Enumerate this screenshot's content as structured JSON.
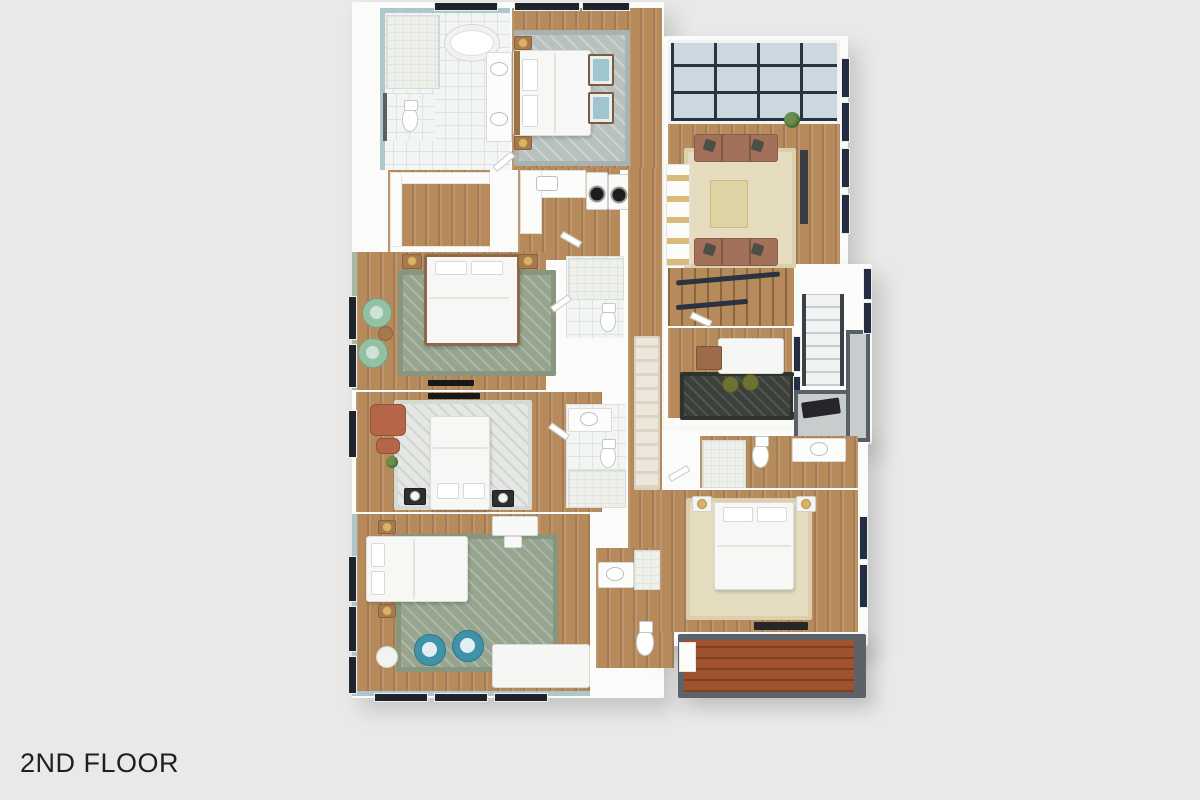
{
  "caption": {
    "text": "2ND FLOOR"
  },
  "palette": {
    "bg": "#e9e9e8",
    "wall": "#fbfbfa",
    "wood": "#b78a5c",
    "tile": "#f3f5f4",
    "tileLine": "#dde3e2",
    "showerTile": "#eef0ec",
    "blueWall": "#aec7cd",
    "sageWall": "#a9b8a2",
    "skyGlass": "#ccd8df",
    "skyFrame": "#2b3340",
    "windowDark": "#1e242c",
    "windowNavy": "#232e42",
    "rugGray": "#b9c1be",
    "rugSage": "#97a48f",
    "rugWhite": "#e4e7e3",
    "rugCream": "#e6dcc0",
    "rugDark": "#3b403a",
    "runner": "#ece7db",
    "sofaBrown": "#a3705a",
    "chairYellow": "#dfc76d",
    "chairGreen": "#93c1a4",
    "chairTeal": "#3f93a8",
    "chairTerracotta": "#b5654a",
    "poufOlive": "#6e7034",
    "deck": "#a0522e",
    "deckFrame": "#5c6268",
    "landing": "#c9cccd",
    "landingFrame": "#595f66",
    "furnDark": "#26262a",
    "woodFurn": "#a5784e",
    "white": "#f7f7f5",
    "text": "#1f1f1f"
  },
  "semantics": {
    "rooms": [
      "master-bathroom",
      "master-bedroom",
      "sunroom-lounge",
      "walk-in-closet",
      "laundry-room",
      "linen-closet",
      "hallway",
      "bedroom-2",
      "bedroom-3",
      "bedroom-4",
      "bedroom-5",
      "office-nook",
      "center-bathroom",
      "hall-bathroom",
      "ensuite-bathroom",
      "staircase-main",
      "staircase-side",
      "stair-landing",
      "deck"
    ]
  }
}
